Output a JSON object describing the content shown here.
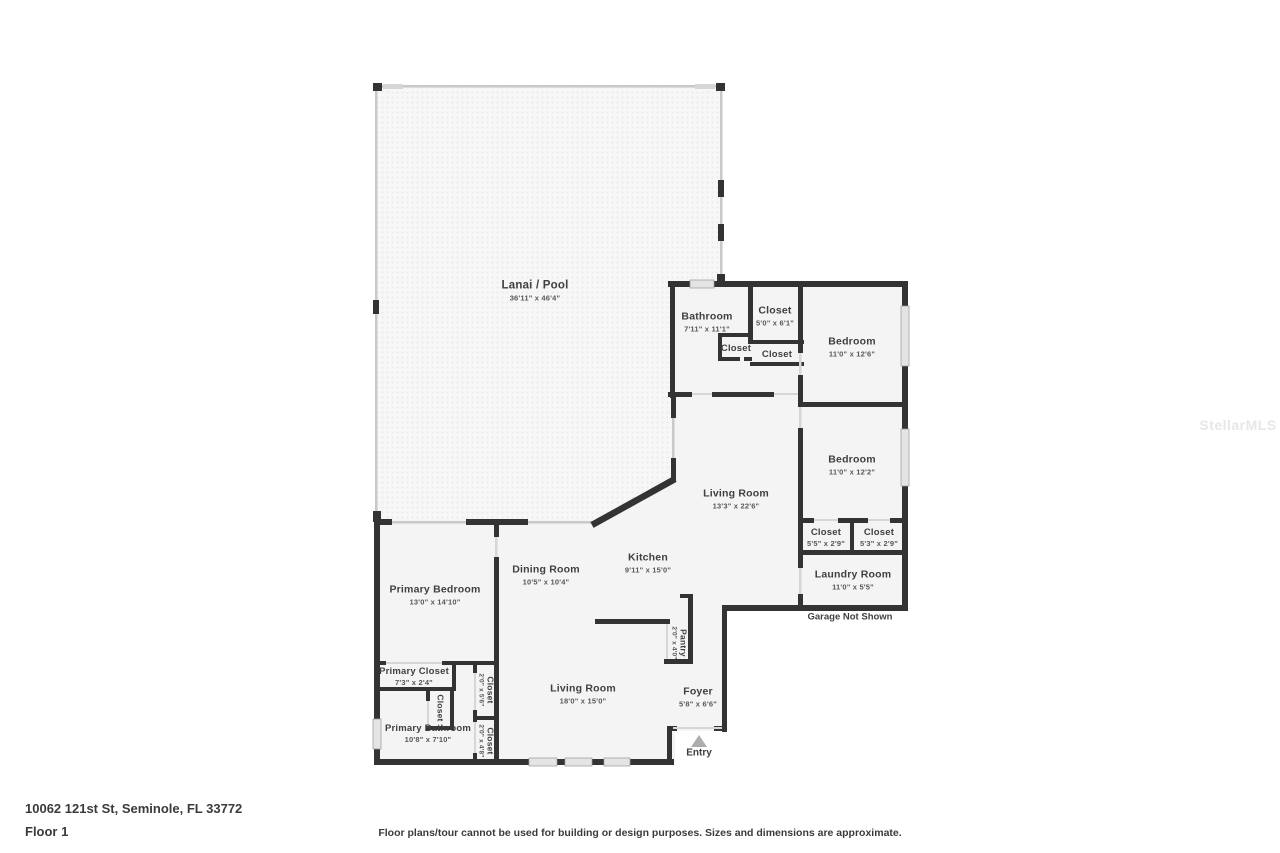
{
  "page": {
    "address": "10062 121st St, Seminole, FL 33772",
    "floor_label": "Floor 1",
    "disclaimer": "Floor plans/tour cannot be used for building or design purposes. Sizes and dimensions are approximate.",
    "watermark": "StellarMLS"
  },
  "plan": {
    "garage_note": "Garage Not Shown",
    "entry_label": "Entry",
    "rooms": [
      {
        "id": "lanai",
        "name": "Lanai / Pool",
        "dims": "36'11\" x 46'4\""
      },
      {
        "id": "bathroom",
        "name": "Bathroom",
        "dims": "7'11\" x 11'1\""
      },
      {
        "id": "hall-closet",
        "name": "Closet",
        "dims": "5'0\" x 6'1\""
      },
      {
        "id": "linen-closet",
        "name": "Closet",
        "dims": ""
      },
      {
        "id": "hall-closet-2",
        "name": "Closet",
        "dims": ""
      },
      {
        "id": "bedroom-1",
        "name": "Bedroom",
        "dims": "11'0\" x 12'6\""
      },
      {
        "id": "bedroom-2",
        "name": "Bedroom",
        "dims": "11'0\" x 12'2\""
      },
      {
        "id": "living-room-1",
        "name": "Living Room",
        "dims": "13'3\" x 22'6\""
      },
      {
        "id": "closet-a",
        "name": "Closet",
        "dims": "5'5\" x 2'9\""
      },
      {
        "id": "closet-b",
        "name": "Closet",
        "dims": "5'3\" x 2'9\""
      },
      {
        "id": "laundry-room",
        "name": "Laundry Room",
        "dims": "11'0\" x 5'5\""
      },
      {
        "id": "kitchen",
        "name": "Kitchen",
        "dims": "9'11\" x 15'0\""
      },
      {
        "id": "dining-room",
        "name": "Dining Room",
        "dims": "10'5\" x 10'4\""
      },
      {
        "id": "primary-bedroom",
        "name": "Primary Bedroom",
        "dims": "13'0\" x 14'10\""
      },
      {
        "id": "primary-closet",
        "name": "Primary Closet",
        "dims": "7'3\" x 2'4\""
      },
      {
        "id": "closet-vert-small",
        "name": "Closet",
        "dims": ""
      },
      {
        "id": "primary-bathroom",
        "name": "Primary Bathroom",
        "dims": "10'8\" x 7'10\""
      },
      {
        "id": "closet-v1",
        "name": "Closet",
        "dims": "2'0\" x 5'6\""
      },
      {
        "id": "closet-v2",
        "name": "Closet",
        "dims": "2'0\" x 4'8\""
      },
      {
        "id": "living-room-2",
        "name": "Living Room",
        "dims": "18'0\" x 15'0\""
      },
      {
        "id": "pantry",
        "name": "Pantry",
        "dims": "2'0\" x 4'0\""
      },
      {
        "id": "foyer",
        "name": "Foyer",
        "dims": "5'8\" x 6'6\""
      }
    ]
  },
  "colors": {
    "wall": "#333333",
    "screen_wall": "#c9c9c9",
    "floor": "#f4f4f4",
    "window": "#e4e4e4",
    "label_text": "#404040"
  }
}
